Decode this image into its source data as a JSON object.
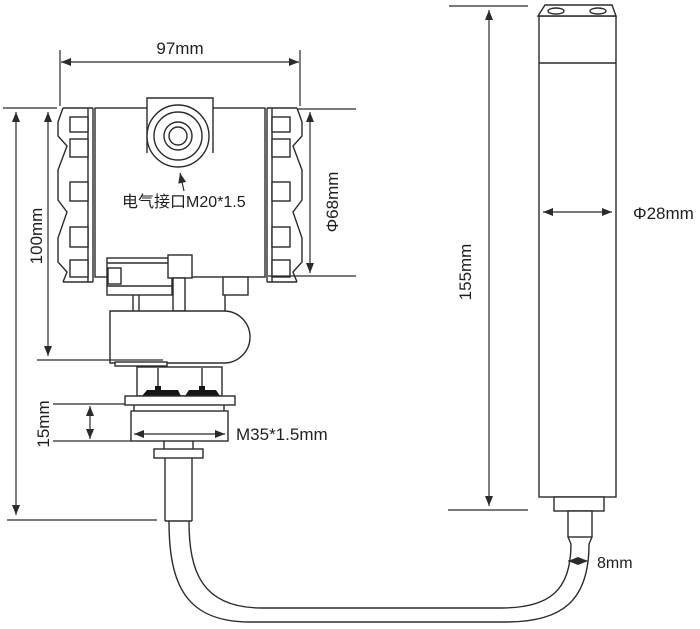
{
  "diagram": {
    "kind": "engineering-dimension-drawing",
    "subject": "pressure transmitter with submersible level probe and connecting cable",
    "background_color": "#ffffff",
    "line_color": "#2b2b2b",
    "labels": {
      "housing_width": "97mm",
      "housing_height": "100mm",
      "electrical_interface": "电气接口M20*1.5",
      "housing_diameter": "Φ68mm",
      "thread_length": "15mm",
      "thread_spec": "M35*1.5mm",
      "probe_length": "155mm",
      "probe_diameter": "Φ28mm",
      "cable_diameter": "8mm"
    }
  }
}
